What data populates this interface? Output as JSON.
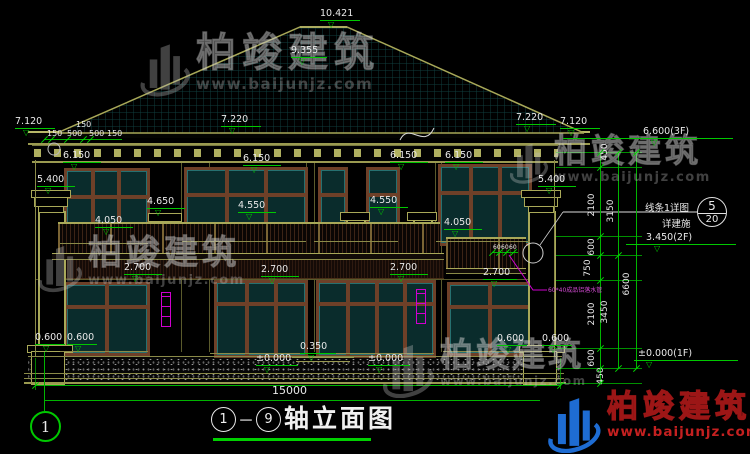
{
  "title": {
    "start": "1",
    "dash": "－",
    "end": "9",
    "name": "轴立面图"
  },
  "axis": {
    "bottom_left": "1"
  },
  "dims": {
    "total": "15000",
    "eave": [
      {
        "t": "150",
        "x": 47,
        "y": 130
      },
      {
        "t": "500",
        "x": 67,
        "y": 130
      },
      {
        "t": "500",
        "x": 89,
        "y": 130
      },
      {
        "t": "150",
        "x": 107,
        "y": 130
      },
      {
        "t": "150",
        "x": 76,
        "y": 121
      }
    ],
    "vertical": [
      {
        "t": "450",
        "x": 605,
        "y": 152
      },
      {
        "t": "2100",
        "x": 592,
        "y": 205
      },
      {
        "t": "600",
        "x": 592,
        "y": 247
      },
      {
        "t": "750",
        "x": 588,
        "y": 268
      },
      {
        "t": "2100",
        "x": 592,
        "y": 314
      },
      {
        "t": "600",
        "x": 592,
        "y": 358
      },
      {
        "t": "450",
        "x": 601,
        "y": 376
      },
      {
        "t": "3150",
        "x": 611,
        "y": 211
      },
      {
        "t": "3450",
        "x": 605,
        "y": 312
      },
      {
        "t": "6600",
        "x": 627,
        "y": 284
      }
    ],
    "small": [
      {
        "t": "60",
        "x": 493,
        "y": 244
      },
      {
        "t": "60",
        "x": 501,
        "y": 244
      },
      {
        "t": "60",
        "x": 509,
        "y": 244
      }
    ]
  },
  "levels": [
    {
      "t": "10.421",
      "x": 320,
      "y": 9,
      "lw": 40
    },
    {
      "t": "9.355",
      "x": 291,
      "y": 46,
      "lw": 36
    },
    {
      "t": "7.120",
      "x": 15,
      "y": 117,
      "lw": 40
    },
    {
      "t": "7.220",
      "x": 221,
      "y": 115,
      "lw": 40
    },
    {
      "t": "7.220",
      "x": 516,
      "y": 113,
      "lw": 40
    },
    {
      "t": "7.120",
      "x": 560,
      "y": 117,
      "lw": 40
    },
    {
      "t": "6.150",
      "x": 63,
      "y": 151,
      "lw": 38
    },
    {
      "t": "6.150",
      "x": 243,
      "y": 154,
      "lw": 38
    },
    {
      "t": "6.150",
      "x": 390,
      "y": 151,
      "lw": 38
    },
    {
      "t": "6.150",
      "x": 445,
      "y": 151,
      "lw": 38
    },
    {
      "t": "5.400",
      "x": 37,
      "y": 175,
      "lw": 38
    },
    {
      "t": "5.400",
      "x": 538,
      "y": 175,
      "lw": 38
    },
    {
      "t": "4.650",
      "x": 147,
      "y": 197,
      "lw": 38
    },
    {
      "t": "4.550",
      "x": 238,
      "y": 201,
      "lw": 38
    },
    {
      "t": "4.550",
      "x": 370,
      "y": 196,
      "lw": 38
    },
    {
      "t": "4.050",
      "x": 95,
      "y": 216,
      "lw": 38
    },
    {
      "t": "4.050",
      "x": 444,
      "y": 218,
      "lw": 38
    },
    {
      "t": "2.700",
      "x": 124,
      "y": 263,
      "lw": 38
    },
    {
      "t": "2.700",
      "x": 261,
      "y": 265,
      "lw": 38
    },
    {
      "t": "2.700",
      "x": 390,
      "y": 263,
      "lw": 38
    },
    {
      "t": "2.700",
      "x": 483,
      "y": 268,
      "lw": 34
    },
    {
      "t": "0.600",
      "x": 35,
      "y": 333,
      "lw": 30
    },
    {
      "t": "0.600",
      "x": 67,
      "y": 333,
      "lw": 30
    },
    {
      "t": "0.600",
      "x": 497,
      "y": 334,
      "lw": 30
    },
    {
      "t": "0.600",
      "x": 542,
      "y": 334,
      "lw": 30
    },
    {
      "t": "0.350",
      "x": 300,
      "y": 342,
      "lw": 36
    },
    {
      "t": "±0.000",
      "x": 256,
      "y": 354,
      "lw": 42
    },
    {
      "t": "±0.000",
      "x": 368,
      "y": 354,
      "lw": 42
    },
    {
      "t": "6.600(3F)",
      "x": 643,
      "y": 127,
      "lw": 170,
      "lx": -80
    },
    {
      "t": "3.450(2F)",
      "x": 646,
      "y": 233,
      "lw": 110,
      "lx": -20
    },
    {
      "t": "±0.000(1F)",
      "x": 638,
      "y": 349,
      "lw": 104,
      "lx": -4
    }
  ],
  "callout": {
    "label": "线条1详图",
    "note": "详建施",
    "detail_no": "5",
    "sheet_no": "20"
  },
  "notes": {
    "downpipe": "60*40成品铝落水管"
  },
  "watermark": {
    "name": "柏竣建筑",
    "url": "www.baijunjz.com"
  },
  "brand": {
    "name": "柏竣建筑",
    "url": "www.baijunjz.com"
  },
  "colors": {
    "dim_green": "#00c800",
    "outline_olive": "#9a9a50",
    "glass_teal": "#0a2c2c",
    "frame_brown": "#6e4028",
    "pipe_magenta": "#cf00cf",
    "brand_blue": "#1e6cd2",
    "brand_red": "#c42020",
    "text_white": "#e9e9e9"
  }
}
